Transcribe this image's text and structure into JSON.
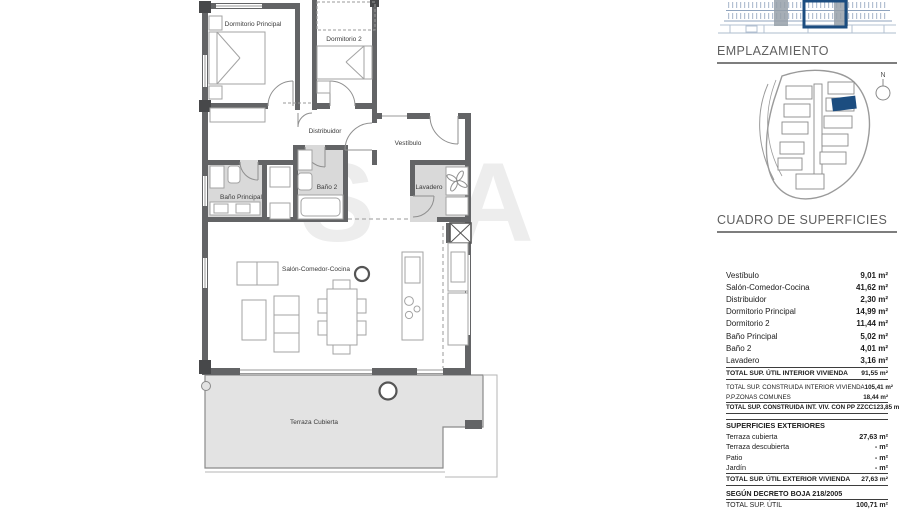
{
  "floorplan": {
    "rooms": {
      "dormitorio_principal": "Dormitorio Principal",
      "dormitorio2": "Dormitorio 2",
      "distribuidor": "Distribuidor",
      "vestibulo": "Vestíbulo",
      "bano_principal": "Baño Principal",
      "bano2": "Baño 2",
      "lavadero": "Lavadero",
      "salon": "Salón-Comedor-Cocina",
      "terraza": "Terraza Cubierta"
    },
    "watermark": "SA"
  },
  "sidebar": {
    "emplazamiento_title": "EMPLAZAMIENTO",
    "compass_label": "N",
    "cuadro_title": "CUADRO DE SUPERFICIES",
    "accent_color": "#1c4d80",
    "interior": {
      "rows": [
        {
          "label": "Vestíbulo",
          "value": "9,01 m²"
        },
        {
          "label": "Salón-Comedor-Cocina",
          "value": "41,62 m²"
        },
        {
          "label": "Distribuidor",
          "value": "2,30 m²"
        },
        {
          "label": "Dormitorio Principal",
          "value": "14,99 m²"
        },
        {
          "label": "Dormitorio 2",
          "value": "11,44 m²"
        },
        {
          "label": "Baño Principal",
          "value": "5,02 m²"
        },
        {
          "label": "Baño 2",
          "value": "4,01 m²"
        },
        {
          "label": "Lavadero",
          "value": "3,16 m²"
        }
      ],
      "total": {
        "label": "TOTAL SUP. ÚTIL INTERIOR VIVIENDA",
        "value": "91,55 m²"
      }
    },
    "construida": {
      "rows": [
        {
          "label": "TOTAL SUP. CONSTRUIDA INTERIOR VIVIENDA",
          "value": "105,41 m²"
        },
        {
          "label": "P.P.ZONAS COMUNES",
          "value": "18,44 m²"
        }
      ],
      "total": {
        "label": "TOTAL SUP. CONSTRUIDA INT. VIV. CON PP ZZCC",
        "value": "123,85 m²"
      }
    },
    "exteriores": {
      "title": "SUPERFICIES EXTERIORES",
      "rows": [
        {
          "label": "Terraza cubierta",
          "value": "27,63 m²"
        },
        {
          "label": "Terraza descubierta",
          "value": "- m²"
        },
        {
          "label": "Patio",
          "value": "- m²"
        },
        {
          "label": "Jardín",
          "value": "- m²"
        }
      ],
      "total": {
        "label": "TOTAL SUP. ÚTIL EXTERIOR VIVIENDA",
        "value": "27,63 m²"
      }
    },
    "decreto": {
      "title": "SEGÚN DECRETO BOJA 218/2005",
      "rows": [
        {
          "label": "TOTAL SUP. ÚTIL",
          "value": "100,71 m²"
        }
      ]
    }
  }
}
